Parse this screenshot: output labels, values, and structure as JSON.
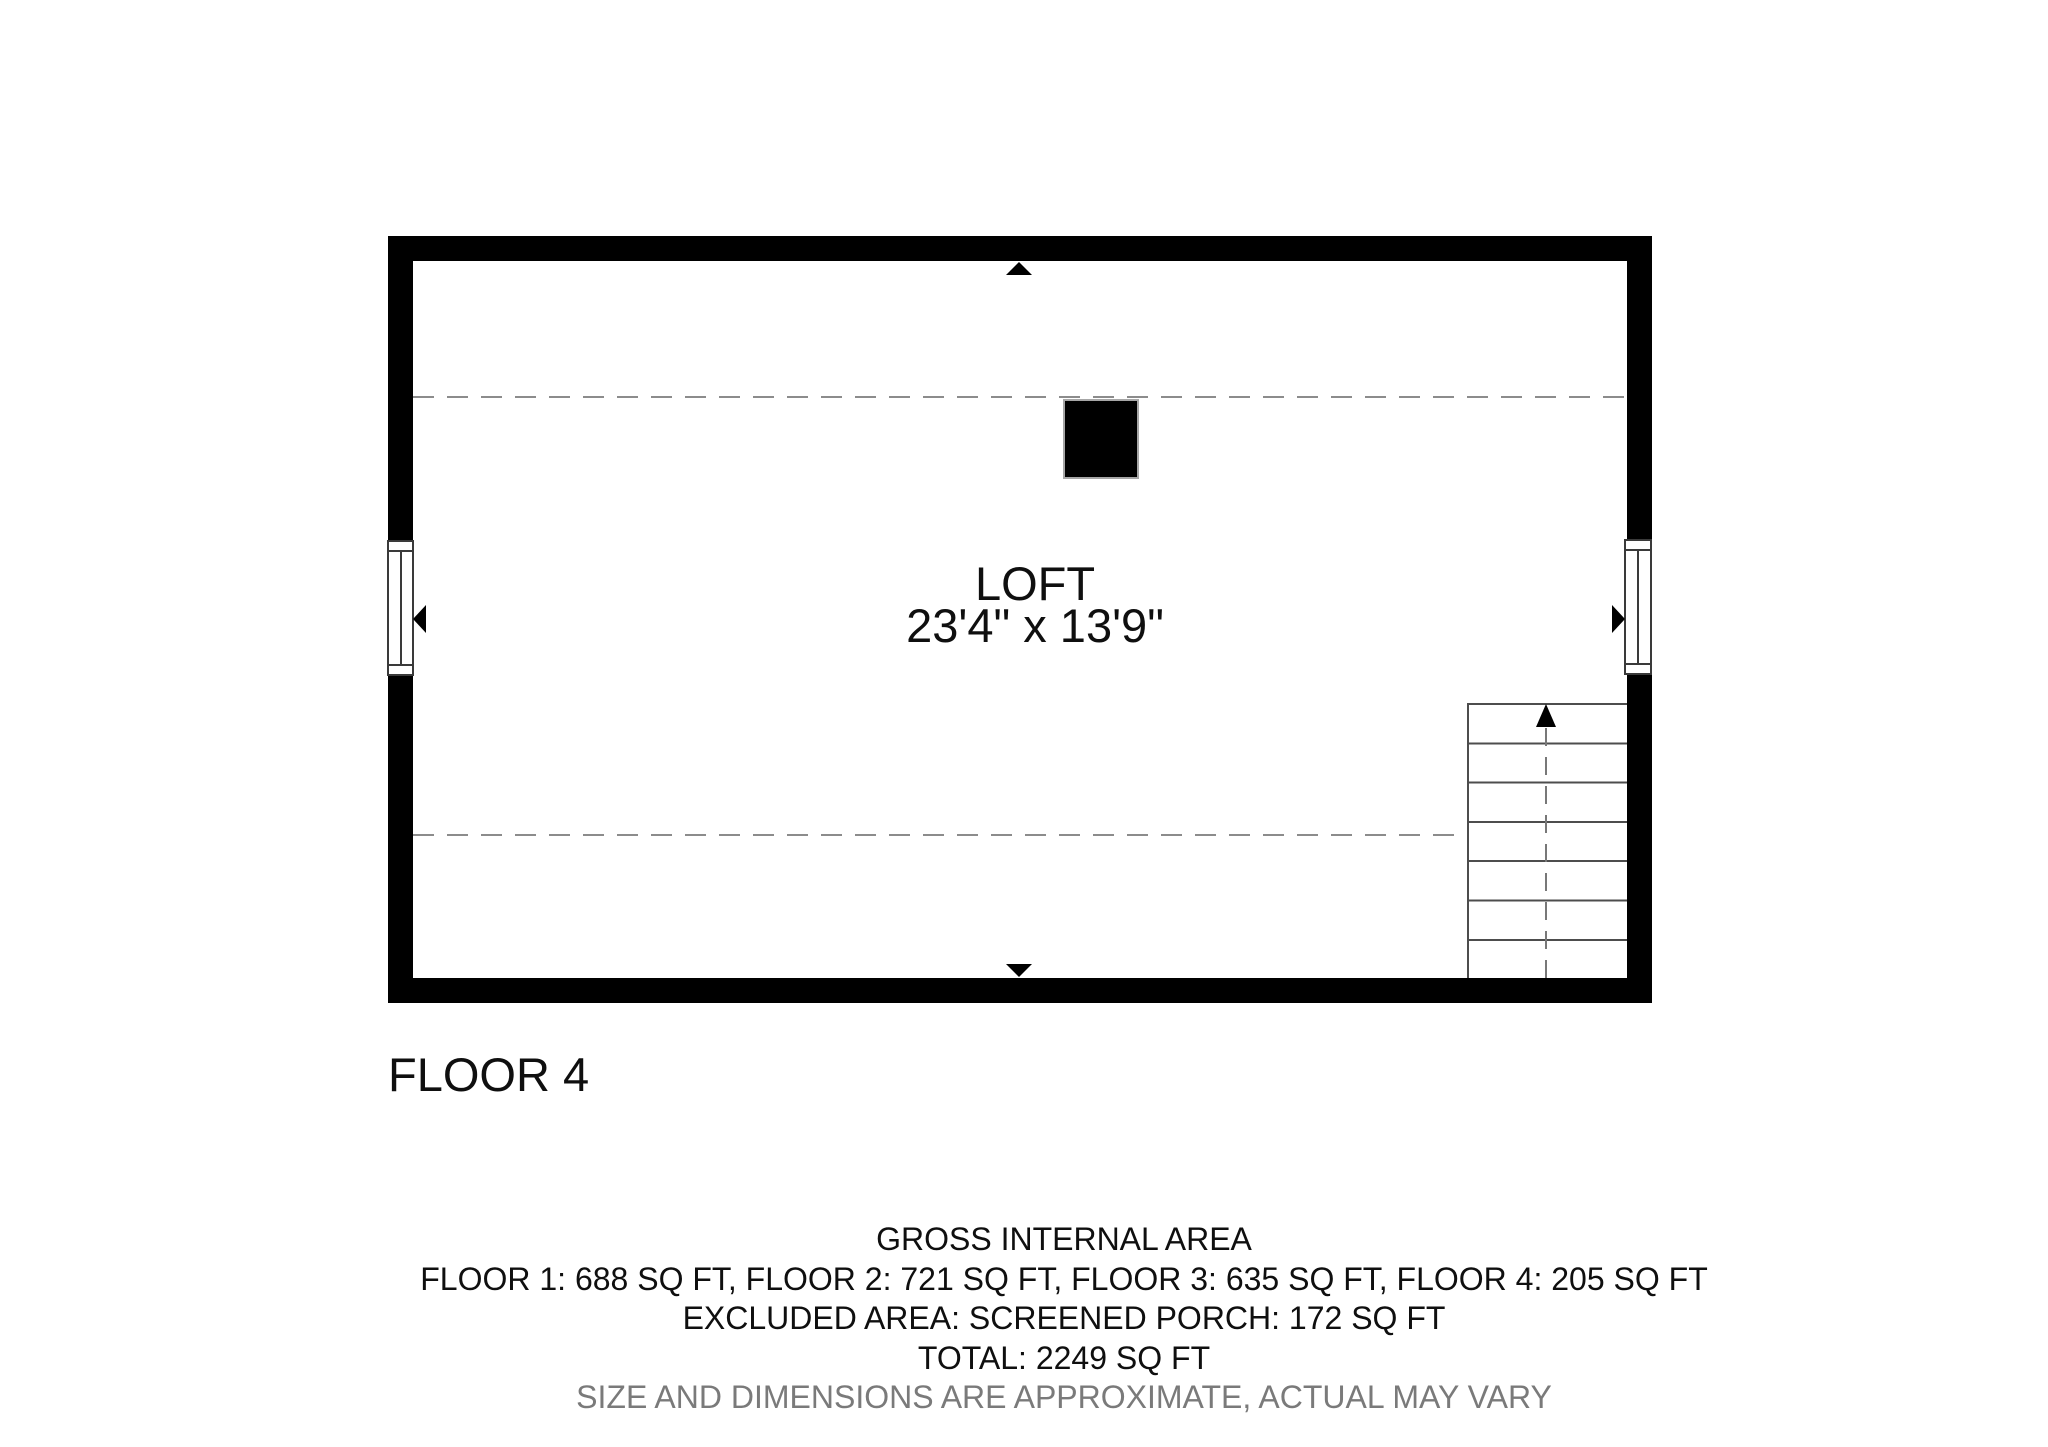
{
  "document": {
    "type": "floor-plan"
  },
  "plan": {
    "floor_label": "FLOOR 4",
    "room": {
      "name": "LOFT",
      "dimensions": "23'4\" x 13'9\""
    },
    "stairs": {
      "direction": "up",
      "steps": 7
    }
  },
  "footer": {
    "title": "GROSS INTERNAL AREA",
    "floor_areas": "FLOOR 1: 688 SQ FT, FLOOR 2: 721 SQ FT, FLOOR 3: 635 SQ FT, FLOOR 4: 205 SQ FT",
    "excluded": "EXCLUDED AREA: SCREENED PORCH: 172 SQ FT",
    "total": "TOTAL: 2249 SQ FT",
    "disclaimer": "SIZE AND DIMENSIONS ARE APPROXIMATE, ACTUAL MAY VARY"
  },
  "colors": {
    "wall": "#000000",
    "dashed_line": "#8c8c8c",
    "text": "#0f0f0f",
    "disclaimer_text": "#7a7a7a"
  }
}
